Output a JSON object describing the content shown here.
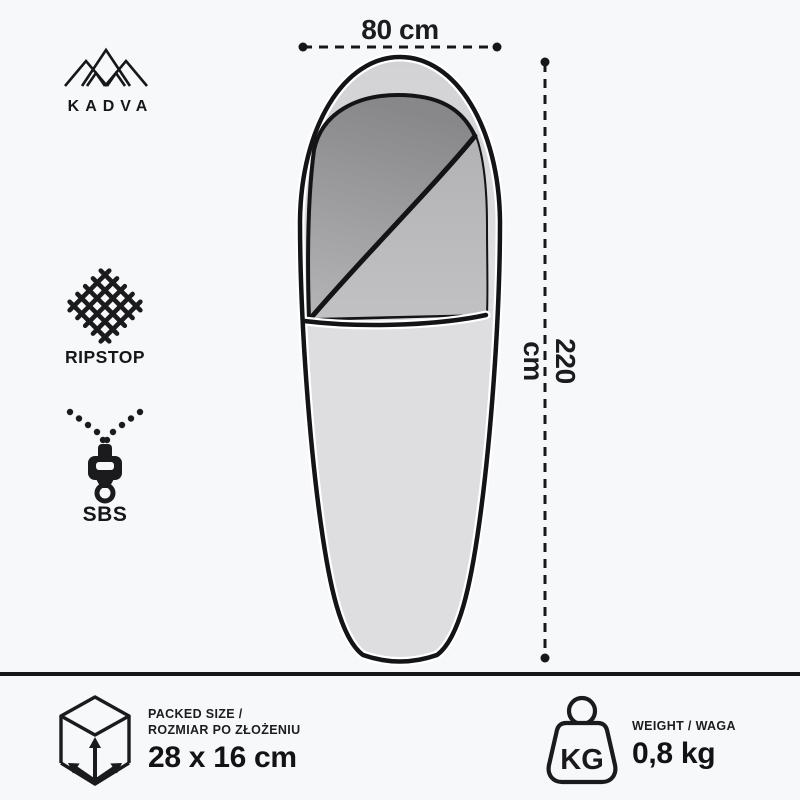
{
  "brand": {
    "name": "KADVA"
  },
  "diagram": {
    "width_label": "80 cm",
    "length_label": "220 cm"
  },
  "features": [
    {
      "id": "ripstop",
      "label": "RIPSTOP"
    },
    {
      "id": "sbs",
      "label": "SBS"
    }
  ],
  "footer": {
    "packed": {
      "label_line1": "PACKED SIZE /",
      "label_line2": "ROZMIAR PO ZŁOŻENIU",
      "value": "28 x 16 cm"
    },
    "weight": {
      "label": "WEIGHT / WAGA",
      "icon_text": "KG",
      "value": "0,8 kg"
    }
  },
  "colors": {
    "background": "#f7f8f9",
    "ink": "#17171a",
    "bag_body": "#dcdcde",
    "bag_opening_dark": "#8b8b8e",
    "bag_flap": "#b6b6b8"
  }
}
